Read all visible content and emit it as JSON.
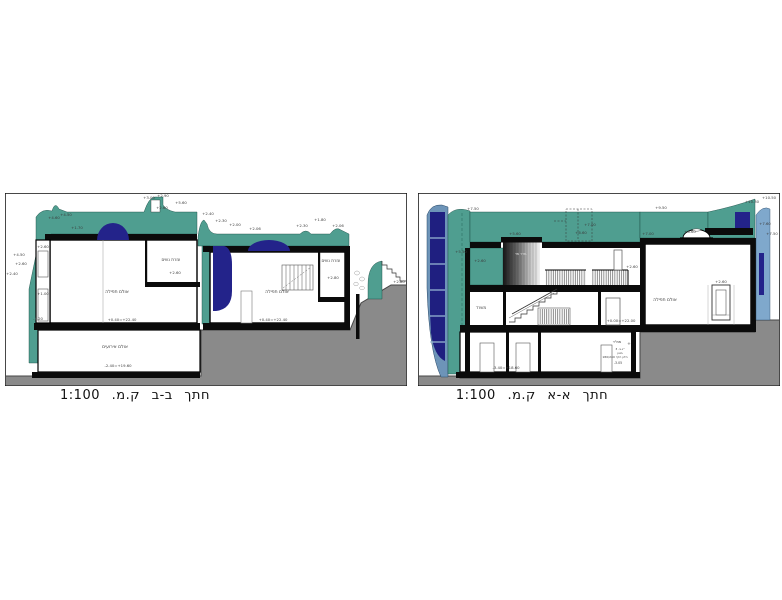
{
  "document": {
    "background": "#ffffff",
    "type_note": "architectural cross sections"
  },
  "colors": {
    "teal_wall": "#4f9e90",
    "navy_glass": "#23238a",
    "steel_blue_glass": "#6d94b8",
    "light_blue_band": "#7fa8cc",
    "ground_gray": "#8a8a8a",
    "ground_edge": "#474747",
    "slab_black": "#0b0b0b",
    "label_gray": "#3c3c3c"
  },
  "sections": [
    {
      "id": "bb",
      "title": "חתך  ב-ב  ק.מ.  1:100",
      "labels": [
        {
          "x": 144,
          "y": 6,
          "t": "+3.00"
        },
        {
          "x": 158,
          "y": 4,
          "t": "+2.90"
        },
        {
          "x": 176,
          "y": 11,
          "t": "+5.60"
        },
        {
          "x": 157,
          "y": 16,
          "t": "+2.60"
        },
        {
          "x": 49,
          "y": 26,
          "t": "+4.60"
        },
        {
          "x": 61,
          "y": 23,
          "t": "+4.50"
        },
        {
          "x": 14,
          "y": 63,
          "t": "+4.50"
        },
        {
          "x": 16,
          "y": 72,
          "t": "+2.60"
        },
        {
          "x": 7,
          "y": 82,
          "t": "+2.40"
        },
        {
          "x": 38,
          "y": 55,
          "t": "+2.60"
        },
        {
          "x": 38,
          "y": 102,
          "t": "+1.00"
        },
        {
          "x": 33,
          "y": 127,
          "t": "-1.20"
        },
        {
          "x": 72,
          "y": 36,
          "t": "+1.70"
        },
        {
          "x": 203,
          "y": 22,
          "t": "+2.40"
        },
        {
          "x": 216,
          "y": 29,
          "t": "+2.30"
        },
        {
          "x": 230,
          "y": 33,
          "t": "+2.00"
        },
        {
          "x": 250,
          "y": 37,
          "t": "+2.06"
        },
        {
          "x": 297,
          "y": 34,
          "t": "+2.30"
        },
        {
          "x": 315,
          "y": 28,
          "t": "+1.80"
        },
        {
          "x": 333,
          "y": 34,
          "t": "+2.06"
        },
        {
          "x": 166,
          "y": 68,
          "t": "עזרת נשים",
          "s": 4.2,
          "n": "room-label"
        },
        {
          "x": 170,
          "y": 81,
          "t": "+2.60"
        },
        {
          "x": 326,
          "y": 69,
          "t": "עזרת נשים",
          "s": 4.2,
          "n": "room-label"
        },
        {
          "x": 328,
          "y": 86,
          "t": "+2.80"
        },
        {
          "x": 112,
          "y": 100,
          "t": "אולם תפילה",
          "s": 4.5,
          "n": "room-label"
        },
        {
          "x": 117,
          "y": 128,
          "t": "+0.40=+22.40"
        },
        {
          "x": 272,
          "y": 100,
          "t": "אולם תפילה",
          "s": 4.5,
          "n": "room-label"
        },
        {
          "x": 268,
          "y": 128,
          "t": "+0.40=+22.40"
        },
        {
          "x": 110,
          "y": 155,
          "t": "אולם אירועים",
          "s": 4.5,
          "n": "room-label"
        },
        {
          "x": 113,
          "y": 174,
          "t": "-2.40=+19.60"
        },
        {
          "x": 394,
          "y": 90,
          "t": "+2.80"
        }
      ]
    },
    {
      "id": "aa",
      "title": "חתך  א-א  ק.מ.  1:100",
      "labels": [
        {
          "x": 55,
          "y": 17,
          "t": "+7.50"
        },
        {
          "x": 43,
          "y": 60,
          "t": "+5.50"
        },
        {
          "x": 62,
          "y": 69,
          "t": "+2.60"
        },
        {
          "x": 97,
          "y": 42,
          "t": "+5.60"
        },
        {
          "x": 172,
          "y": 33,
          "t": "+7.00"
        },
        {
          "x": 163,
          "y": 41,
          "t": "+6.60"
        },
        {
          "x": 243,
          "y": 16,
          "t": "+9.50"
        },
        {
          "x": 230,
          "y": 42,
          "t": "+7.00"
        },
        {
          "x": 272,
          "y": 40,
          "t": "+6.60"
        },
        {
          "x": 334,
          "y": 10,
          "t": "+10.30"
        },
        {
          "x": 351,
          "y": 6,
          "t": "+10.50"
        },
        {
          "x": 347,
          "y": 32,
          "t": "+7.60"
        },
        {
          "x": 354,
          "y": 42,
          "t": "+7.50"
        },
        {
          "x": 214,
          "y": 75,
          "t": "+2.60"
        },
        {
          "x": 303,
          "y": 90,
          "t": "+2.60"
        },
        {
          "x": 203,
          "y": 129,
          "t": "+0.00=+22.00"
        },
        {
          "x": 88,
          "y": 176,
          "t": "-3.40=+18.60"
        },
        {
          "x": 63,
          "y": 116,
          "t": "משרד",
          "s": 4.2,
          "n": "room-label"
        },
        {
          "x": 247,
          "y": 108,
          "t": "אולם תפילה",
          "s": 4.5,
          "n": "room-label"
        },
        {
          "x": 103,
          "y": 62,
          "t": "חדר מד.",
          "s": 3.4,
          "c": "#e2e2e2",
          "n": "room-label"
        },
        {
          "x": 199,
          "y": 150,
          "t": "ממ\"ד",
          "s": 3.6,
          "n": "room-label"
        },
        {
          "x": 211,
          "y": 152,
          "t": "+",
          "s": 4.4
        },
        {
          "x": 202,
          "y": 157,
          "t": "ג.ב. 3\"",
          "s": 3
        },
        {
          "x": 202,
          "y": 161,
          "t": "בטון",
          "s": 3
        },
        {
          "x": 197,
          "y": 165,
          "t": "180/240 חלון הדף",
          "s": 3
        },
        {
          "x": 200,
          "y": 171,
          "t": "-3.05",
          "s": 3.2
        }
      ]
    }
  ]
}
